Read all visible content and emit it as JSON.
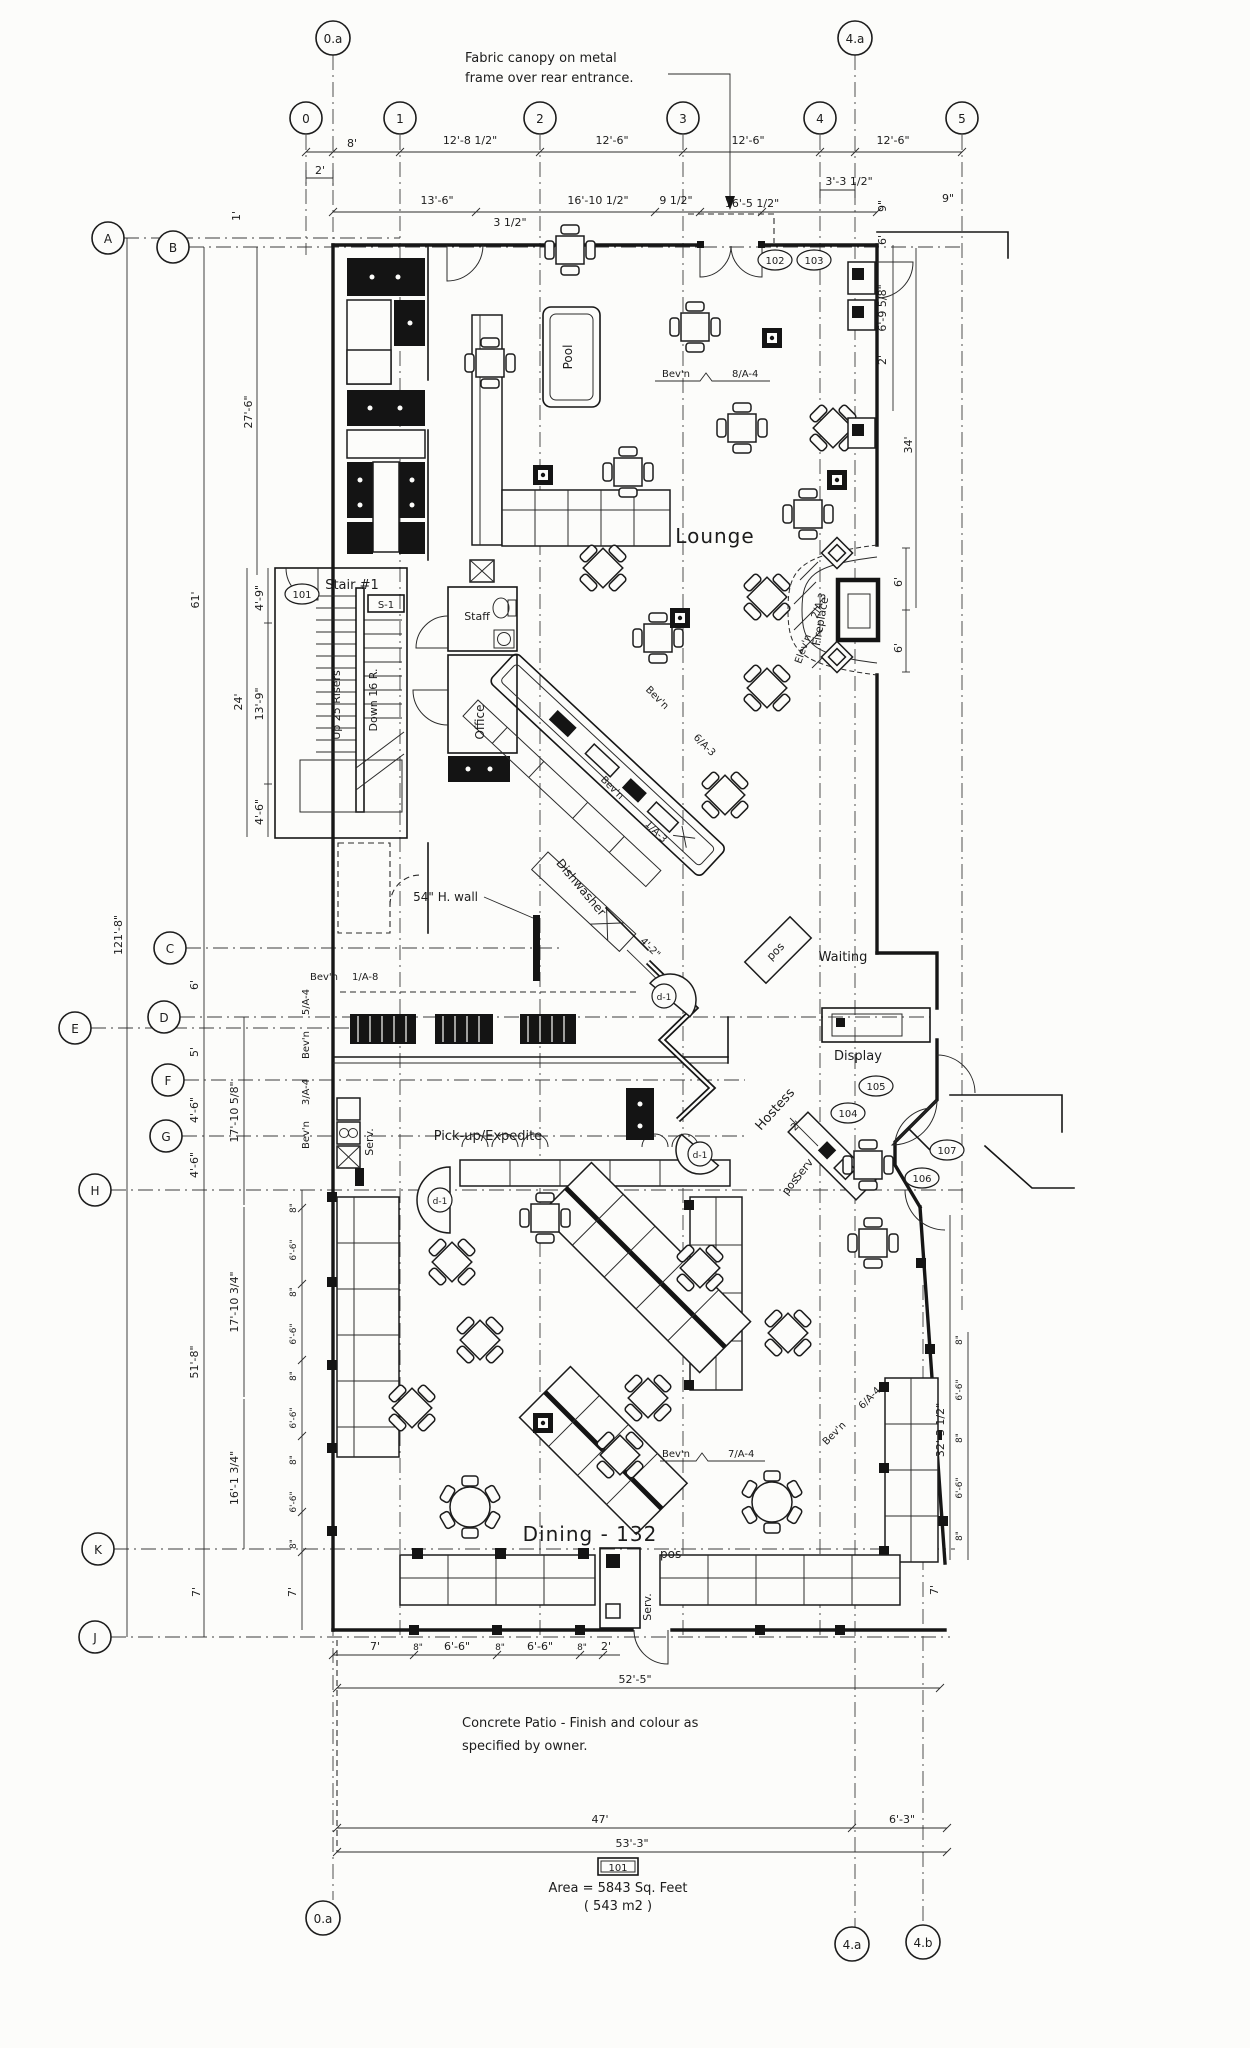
{
  "grid": {
    "top": [
      "0.a",
      "0",
      "1",
      "2",
      "3",
      "4",
      "4.a",
      "5"
    ],
    "left": [
      "A",
      "B",
      "C",
      "D",
      "E",
      "F",
      "G",
      "H",
      "K",
      "J"
    ],
    "bottom": [
      "0.a",
      "4.a",
      "4.b"
    ]
  },
  "rooms": {
    "lounge": "Lounge",
    "dining": "Dining - 132",
    "pool": "Pool",
    "office": "Office",
    "staff": "Staff",
    "stair_title": "Stair #1",
    "stair_tag": "S-1",
    "stair_up": "Up 25 Risers",
    "stair_down": "Down 16 R.",
    "waiting": "Waiting",
    "display": "Display",
    "hostess": "Hostess",
    "pickup": "Pick-up/Expedite",
    "dishwasher": "Dishwasher",
    "serv_kitchen": "Serv.",
    "serv_dining": "Serv.",
    "serv_entry": "Serv",
    "pos_waiting": "pos",
    "pos_entry": "pos",
    "pos_dining": "pos"
  },
  "notes": {
    "canopy1": "Fabric canopy on metal",
    "canopy2": "frame over rear entrance.",
    "patio1": "Concrete Patio - Finish and colour as",
    "patio2": "specified by owner.",
    "area1": "Area = 5843 Sq. Feet",
    "area2": "( 543 m2 )",
    "wall54": "54\" H. wall"
  },
  "tags": {
    "d101": "101",
    "d102": "102",
    "d103": "103",
    "d104": "104",
    "d105": "105",
    "d106": "106",
    "d107": "107",
    "d1a": "d-1",
    "d1b": "d-1",
    "d1c": "d-1",
    "room": "101"
  },
  "annotations": {
    "bev_lounge": "Bev'n",
    "bev_lounge_ref": "8/A-4",
    "bev_bar1": "Bev'n",
    "bev_bar1_ref": "6/A-3",
    "bev_bar2": "Bev'n",
    "bev_bar2_ref": "1/A-3",
    "elev_fp": "Elev'n",
    "elev_fp_ref": "2/A-3",
    "fireplace": "Fireplace",
    "bev_d1": "Bev'n",
    "bev_d1_ref": "1/A-8",
    "bev_d2": "Bev'n",
    "bev_d2_ref": "5/A-4",
    "bev_d3": "Bev'n",
    "bev_d3_ref": "3/A-4",
    "bev_d4": "Bev'n",
    "bev_d4_ref": "7/A-4",
    "bev_d5": "Bev'n",
    "bev_d5_ref": "6/A-4"
  },
  "dims": {
    "t1": "8'",
    "t2": "12'-8 1/2\"",
    "t3": "12'-6\"",
    "t4": "12'-6\"",
    "t5": "12'-6\"",
    "t6": "2'",
    "t7": "3'-3 1/2\"",
    "t8": "9\"",
    "s1": "13'-6\"",
    "s2": "3 1/2\"",
    "s3": "16'-10 1/2\"",
    "s4": "9 1/2\"",
    "s5": "16'-5 1/2\"",
    "s6": "9\"",
    "r1": "6'",
    "r2": "6'-9 5/8\"",
    "r3": "2'",
    "r4": "34'",
    "r5": "6'",
    "r6": "6'",
    "l1": "1'",
    "l2": "27'-6\"",
    "l3": "61'",
    "l4": "121'-8\"",
    "l5": "24'",
    "l6": "4'-9\"",
    "l7": "13'-9\"",
    "l8": "4'-6\"",
    "l9": "6'",
    "l10": "5'",
    "l11": "4'-6\"",
    "l12": "4'-6\"",
    "l13": "17'-10 5/8\"",
    "l14": "51'-8\"",
    "l15": "17'-10 3/4\"",
    "l16": "16'-1 3/4\"",
    "l17": "7'",
    "l18": "7'",
    "w1": "8\"",
    "w2": "6'-6\"",
    "w3": "8\"",
    "w4": "6'-6\"",
    "w5": "8\"",
    "w6": "6'-6\"",
    "w7": "8\"",
    "w8": "6'-6\"",
    "w9": "8\"",
    "e1": "8\"",
    "e2": "6'-6\"",
    "e3": "8\"",
    "e4": "6'-6\"",
    "e5": "8\"",
    "e6": "32'-3 1/2\"",
    "e7": "7'",
    "e8": "2'",
    "b1": "7'",
    "b2": "8\"",
    "b3": "6'-6\"",
    "b4": "8\"",
    "b5": "6'-6\"",
    "b6": "8\"",
    "b7": "2'",
    "b8": "52'-5\"",
    "b9": "47'",
    "b10": "6'-3\"",
    "b11": "53'-3\"",
    "v1": "4'-2\""
  }
}
